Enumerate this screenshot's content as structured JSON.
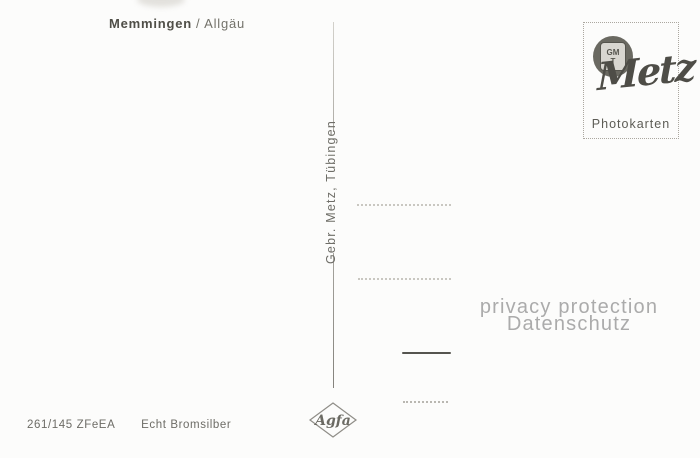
{
  "header": {
    "title_bold": "Memmingen",
    "title_rest": "/ Allgäu"
  },
  "publisher": {
    "vertical_text": "Gebr. Metz, Tübingen"
  },
  "stamp_box": {
    "monogram_top": "GM",
    "monogram_bottom": "T",
    "brand": "Metz",
    "caption": "Photokarten"
  },
  "watermark": {
    "line1": "privacy protection",
    "line2": "Datenschutz"
  },
  "agfa": {
    "label": "Agfa"
  },
  "footer": {
    "code": "261/145 ZFeEA",
    "paper_type": "Echt Bromsilber"
  },
  "colors": {
    "paper": "#fcfcfb",
    "ink_dark": "#4f4e47",
    "ink_medium": "#6d6c66",
    "watermark_gray": "#ababab",
    "line_gray": "#c9c7c1"
  }
}
